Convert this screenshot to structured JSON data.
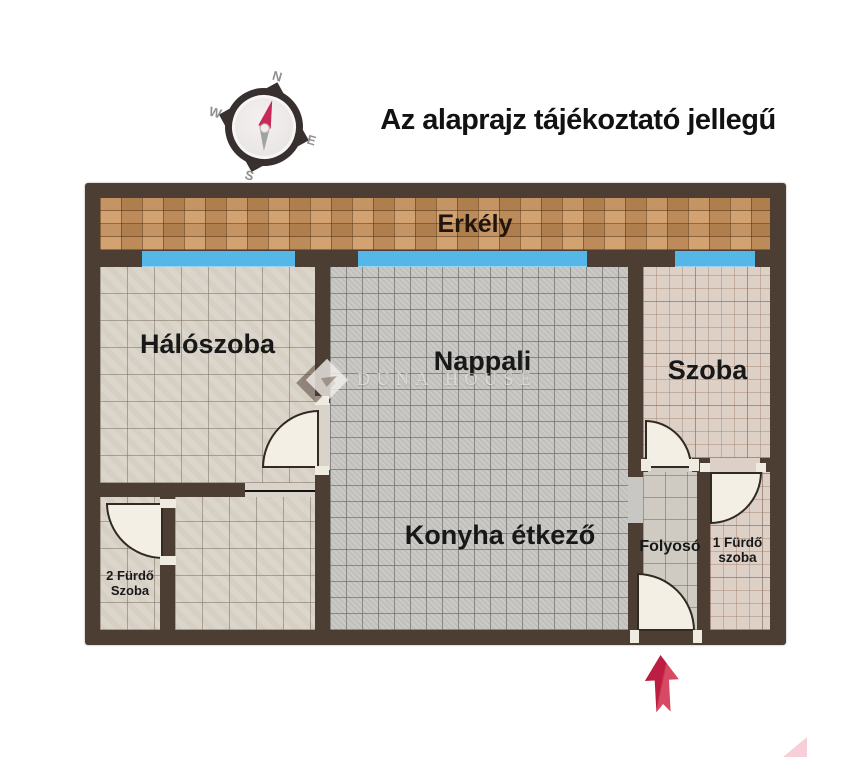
{
  "title": "Az alaprajz tájékoztató jellegű",
  "compass": {
    "north": "N",
    "east": "E",
    "south": "S",
    "west": "W"
  },
  "watermark": {
    "brand": "DUNA HOUSE"
  },
  "rooms": {
    "balcony": {
      "label": "Erkély"
    },
    "bedroom": {
      "label": "Hálószoba"
    },
    "living_room": {
      "label": "Nappali"
    },
    "room": {
      "label": "Szoba"
    },
    "kitchen_dining": {
      "label": "Konyha étkező"
    },
    "hallway": {
      "label": "Folyosó"
    },
    "bathroom_1": {
      "label_line1": "1 Fürdő",
      "label_line2": "szoba"
    },
    "bathroom_2": {
      "label_line1": "2 Fürdő",
      "label_line2": "Szoba"
    }
  },
  "colors": {
    "wall": "#4c3e33",
    "window": "#55b7e8",
    "balcony_tile": "#c8915a",
    "bedroom_tile": "#d9d3c9",
    "living_tile": "#c8c7c4",
    "room_tile": "#ddd0c6",
    "hallway_tile": "#cfcac2",
    "door": "#f4efe5",
    "entrance_arrow": "#c62143",
    "compass_needle_north": "#c62a56"
  },
  "icons": {
    "compass": "compass-rose",
    "entrance_arrow": "up-arrow"
  }
}
